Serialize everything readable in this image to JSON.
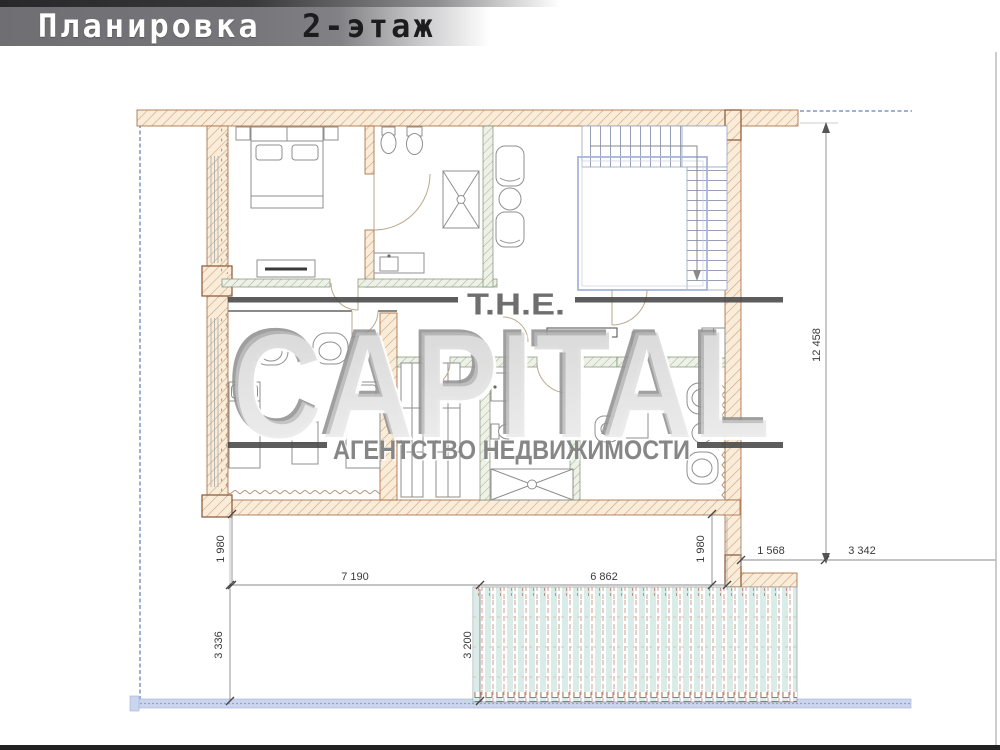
{
  "header": {
    "title": "Планировка",
    "subtitle": "2-этаж"
  },
  "watermark": {
    "top": "T.H.E.",
    "main": "CAPITAL",
    "sub": "АГЕНТСТВО НЕДВИЖИМОСТИ"
  },
  "dimensions": {
    "overall_height": "12 458",
    "left_inset": "1 980",
    "left_span": "7 190",
    "terrace_span": "6 862",
    "right_inset": "1 980",
    "right_step": "1 568",
    "right_span": "3 342",
    "left_depth": "3 336",
    "terrace_depth": "3 200"
  },
  "colors": {
    "header_gray": "#737377",
    "wall_hatch": "#d4a07a",
    "boundary_blue": "#9fb0d8",
    "terrace_teal": "#daece7",
    "watermark_gray": "#8c8c8c"
  }
}
